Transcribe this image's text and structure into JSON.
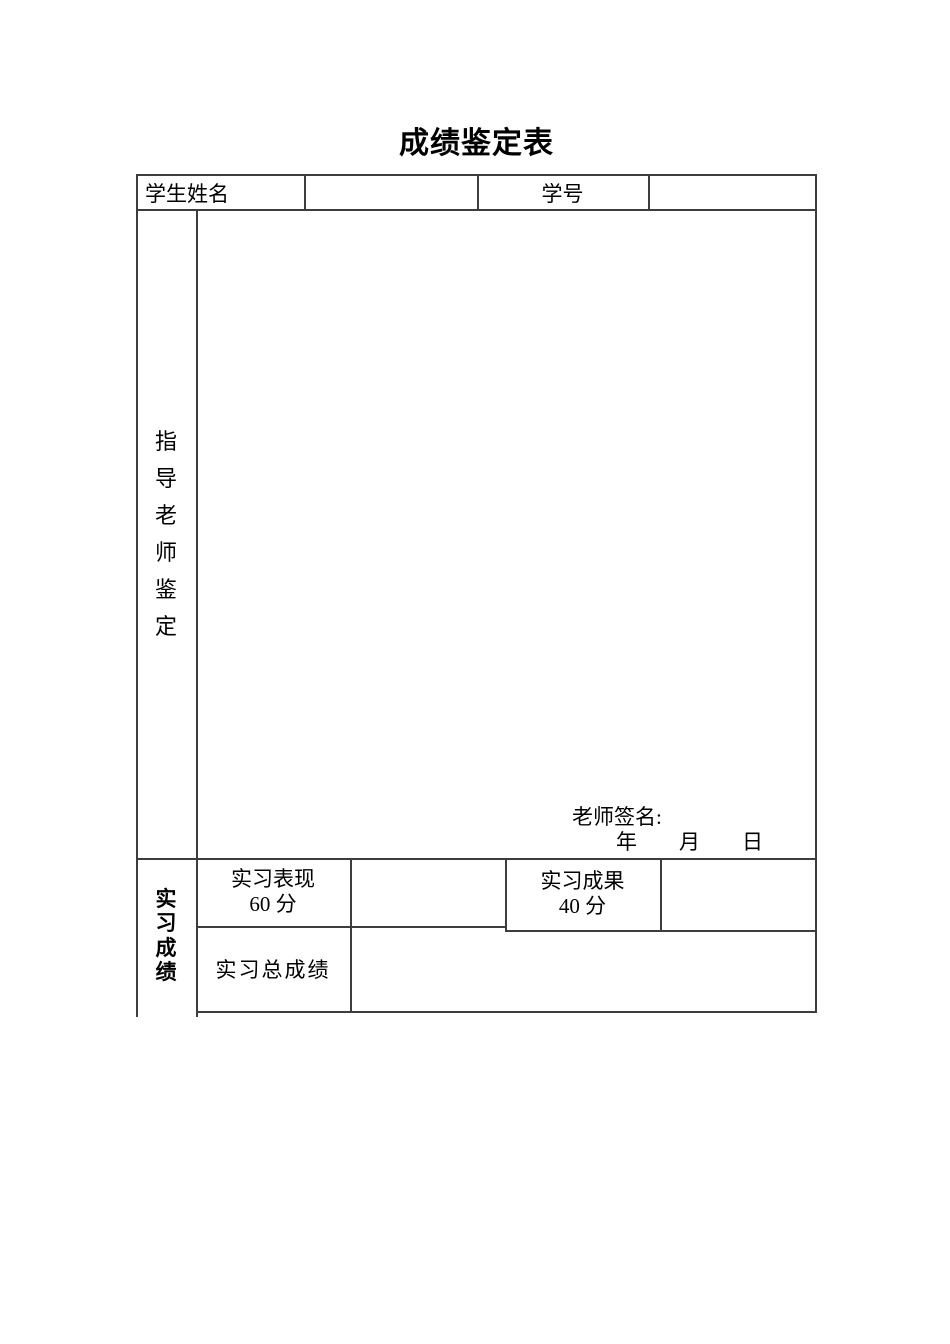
{
  "page": {
    "title": "成绩鉴定表"
  },
  "header_row": {
    "student_name_label": "学生姓名",
    "student_name_value": "",
    "student_id_label": "学号",
    "student_id_value": ""
  },
  "instructor_section": {
    "label_vertical": [
      "指",
      "导",
      "老",
      "师",
      "鉴",
      "定"
    ],
    "comment_value": "",
    "signature_label": "老师签名:",
    "date_line": "年　　月　　日"
  },
  "grade_section": {
    "label_vertical": [
      "实",
      "习",
      "成",
      "绩"
    ],
    "performance_label_line1": "实习表现",
    "performance_label_line2": "60 分",
    "performance_value": "",
    "result_label_line1": "实习成果",
    "result_label_line2": "40 分",
    "result_value": "",
    "total_label": "实习总成绩",
    "total_value": ""
  },
  "colors": {
    "border": "#3d3d3d",
    "text": "#000000",
    "background": "#ffffff"
  }
}
